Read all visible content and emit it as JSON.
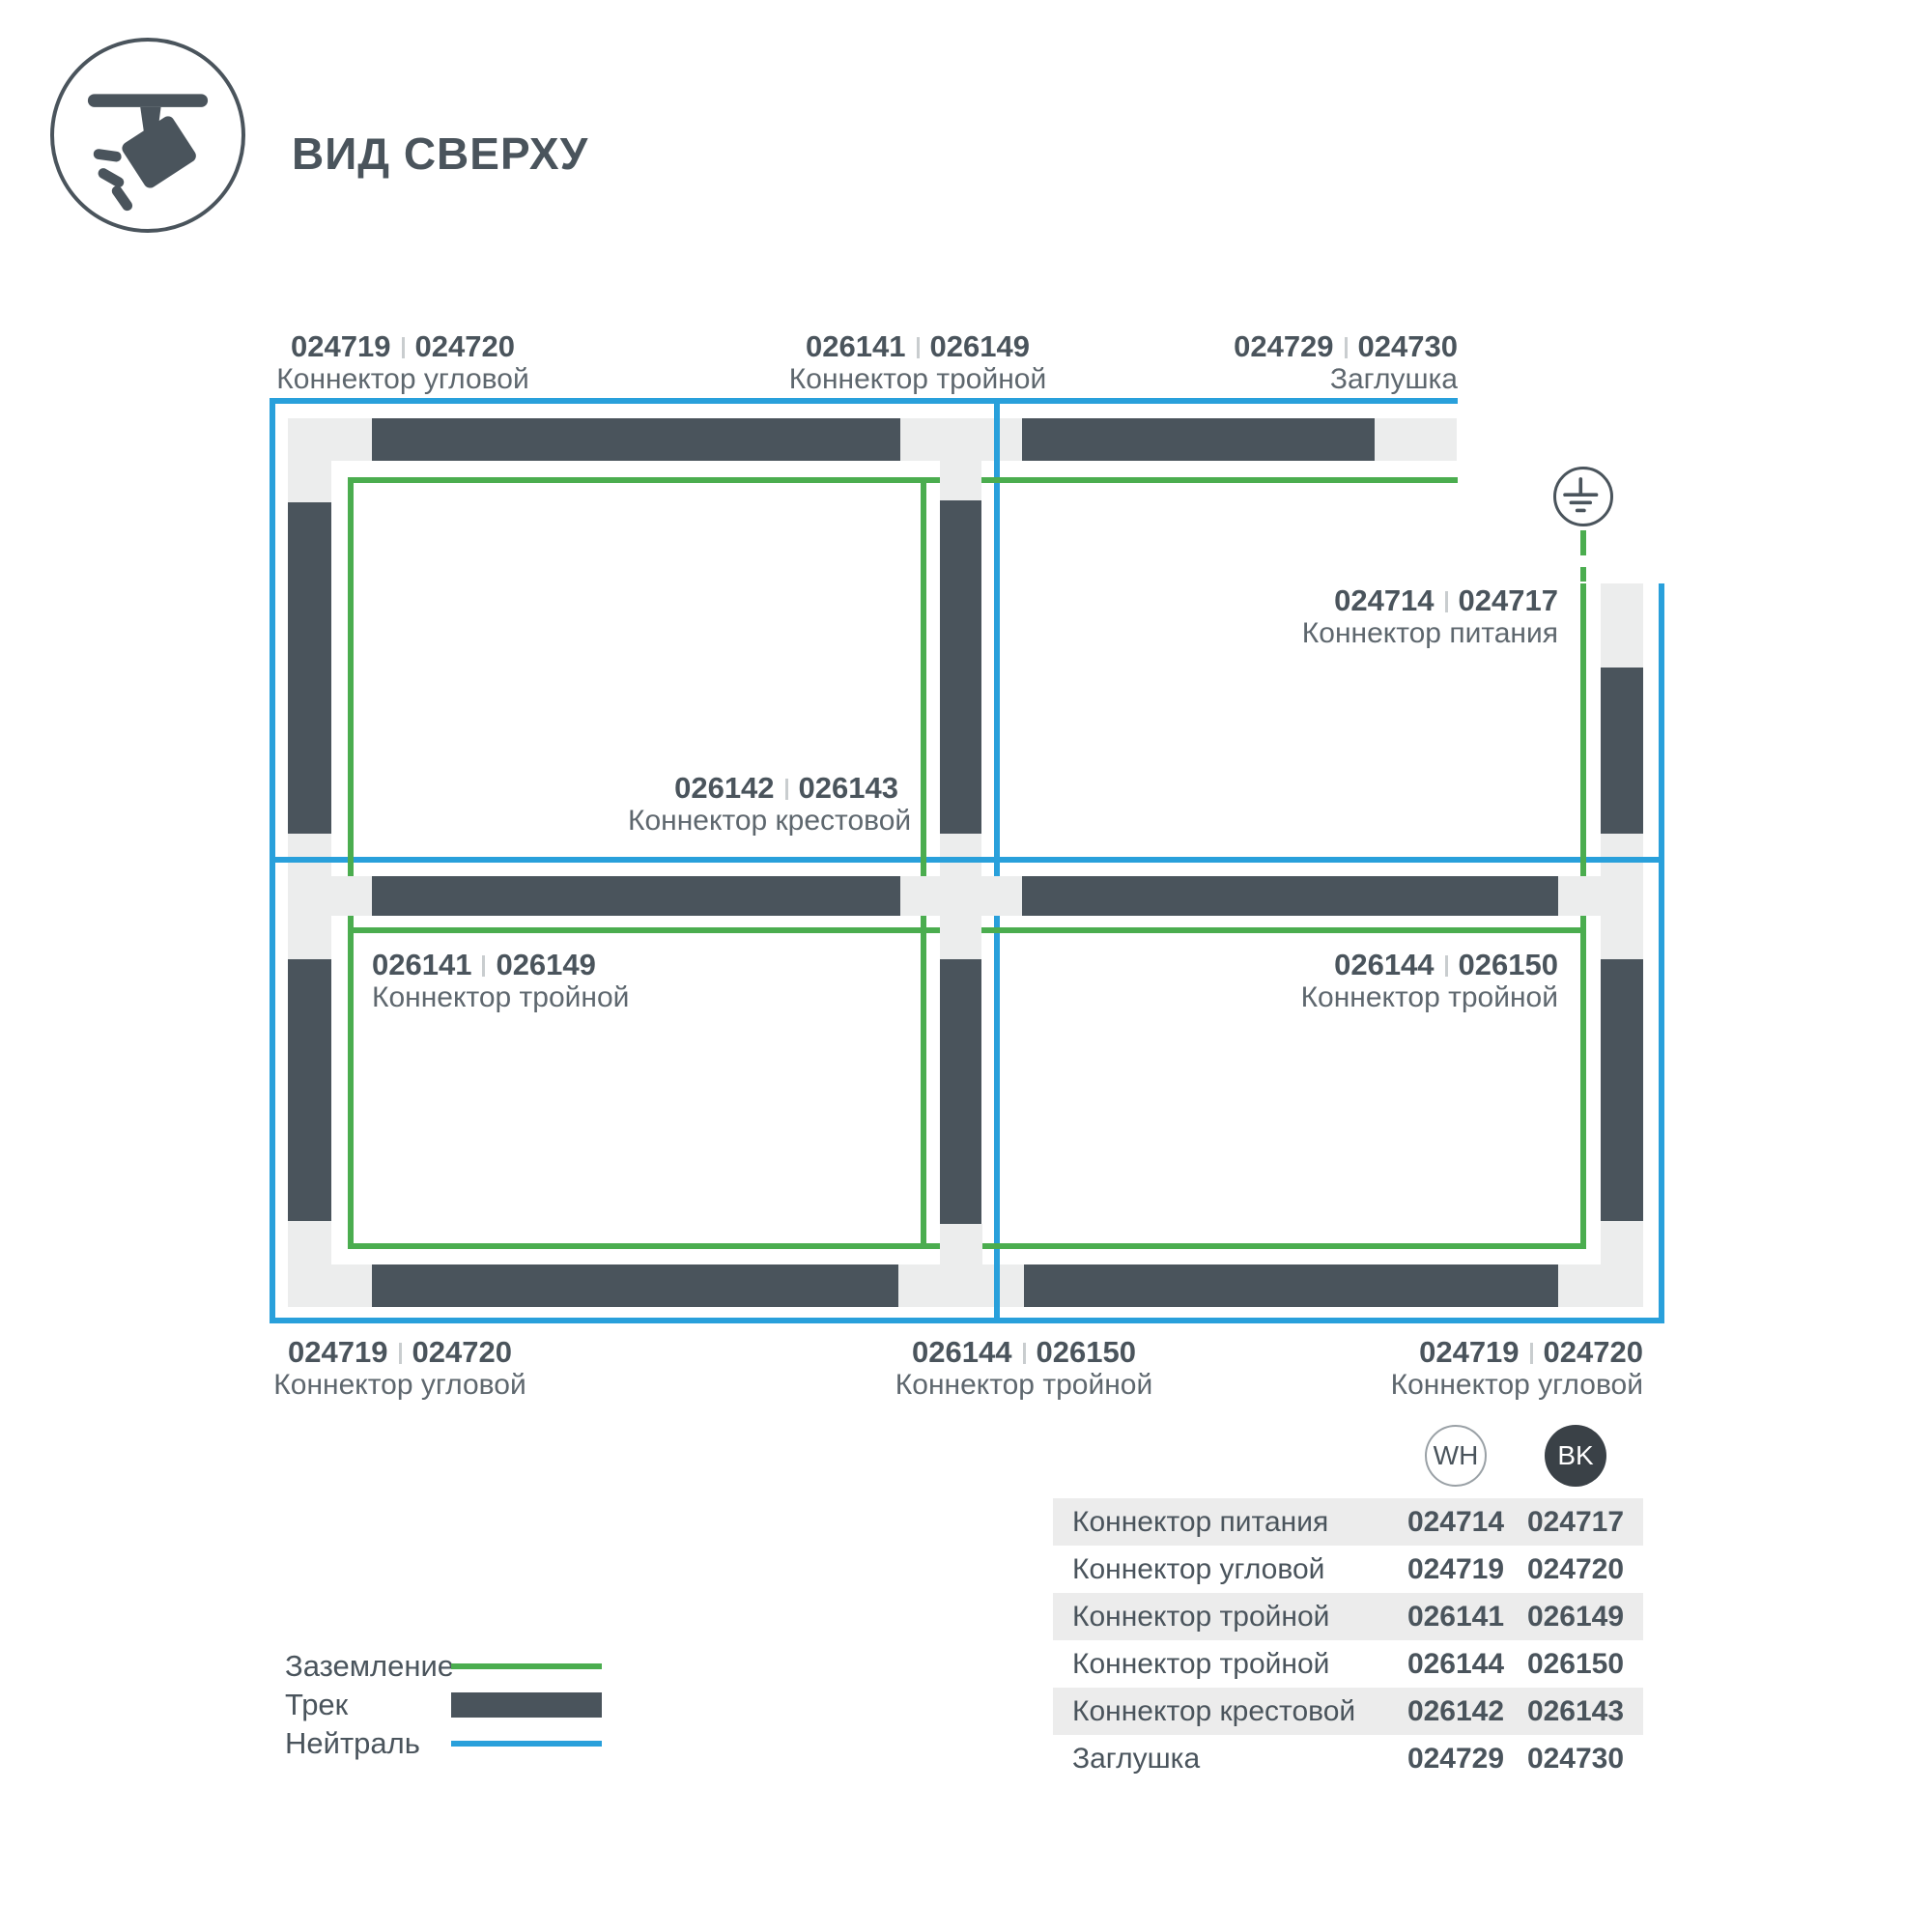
{
  "header": {
    "title": "ВИД СВЕРХУ"
  },
  "colors": {
    "neutral": "#29A0DB",
    "ground": "#4BAD4F",
    "track": "#4A545C",
    "connector": "#ECEDED",
    "row_alt": "#ECECEC"
  },
  "diagram": {
    "callouts": [
      {
        "id": "corner-top-left",
        "wh": "024719",
        "bk": "024720",
        "name": "Коннектор угловой"
      },
      {
        "id": "tee-top",
        "wh": "026141",
        "bk": "026149",
        "name": "Коннектор тройной"
      },
      {
        "id": "endcap-top-right",
        "wh": "024729",
        "bk": "024730",
        "name": "Заглушка"
      },
      {
        "id": "power-feed",
        "wh": "024714",
        "bk": "024717",
        "name": "Коннектор питания"
      },
      {
        "id": "cross-center",
        "wh": "026142",
        "bk": "026143",
        "name": "Коннектор крестовой"
      },
      {
        "id": "tee-mid-left",
        "wh": "026141",
        "bk": "026149",
        "name": "Коннектор тройной"
      },
      {
        "id": "tee-mid-right",
        "wh": "026144",
        "bk": "026150",
        "name": "Коннектор тройной"
      },
      {
        "id": "corner-bottom-left",
        "wh": "024719",
        "bk": "024720",
        "name": "Коннектор угловой"
      },
      {
        "id": "tee-bottom",
        "wh": "026144",
        "bk": "026150",
        "name": "Коннектор тройной"
      },
      {
        "id": "corner-bottom-right",
        "wh": "024719",
        "bk": "024720",
        "name": "Коннектор угловой"
      }
    ]
  },
  "legend": {
    "items": [
      {
        "label": "Заземление",
        "type": "ground-line"
      },
      {
        "label": "Трек",
        "type": "track-bar"
      },
      {
        "label": "Нейтраль",
        "type": "neutral-line"
      }
    ]
  },
  "table": {
    "columns": [
      {
        "id": "wh",
        "label": "WH"
      },
      {
        "id": "bk",
        "label": "BK"
      }
    ],
    "rows": [
      {
        "name": "Коннектор питания",
        "wh": "024714",
        "bk": "024717"
      },
      {
        "name": "Коннектор угловой",
        "wh": "024719",
        "bk": "024720"
      },
      {
        "name": "Коннектор тройной",
        "wh": "026141",
        "bk": "026149"
      },
      {
        "name": "Коннектор тройной",
        "wh": "026144",
        "bk": "026150"
      },
      {
        "name": "Коннектор крестовой",
        "wh": "026142",
        "bk": "026143"
      },
      {
        "name": "Заглушка",
        "wh": "024729",
        "bk": "024730"
      }
    ]
  }
}
